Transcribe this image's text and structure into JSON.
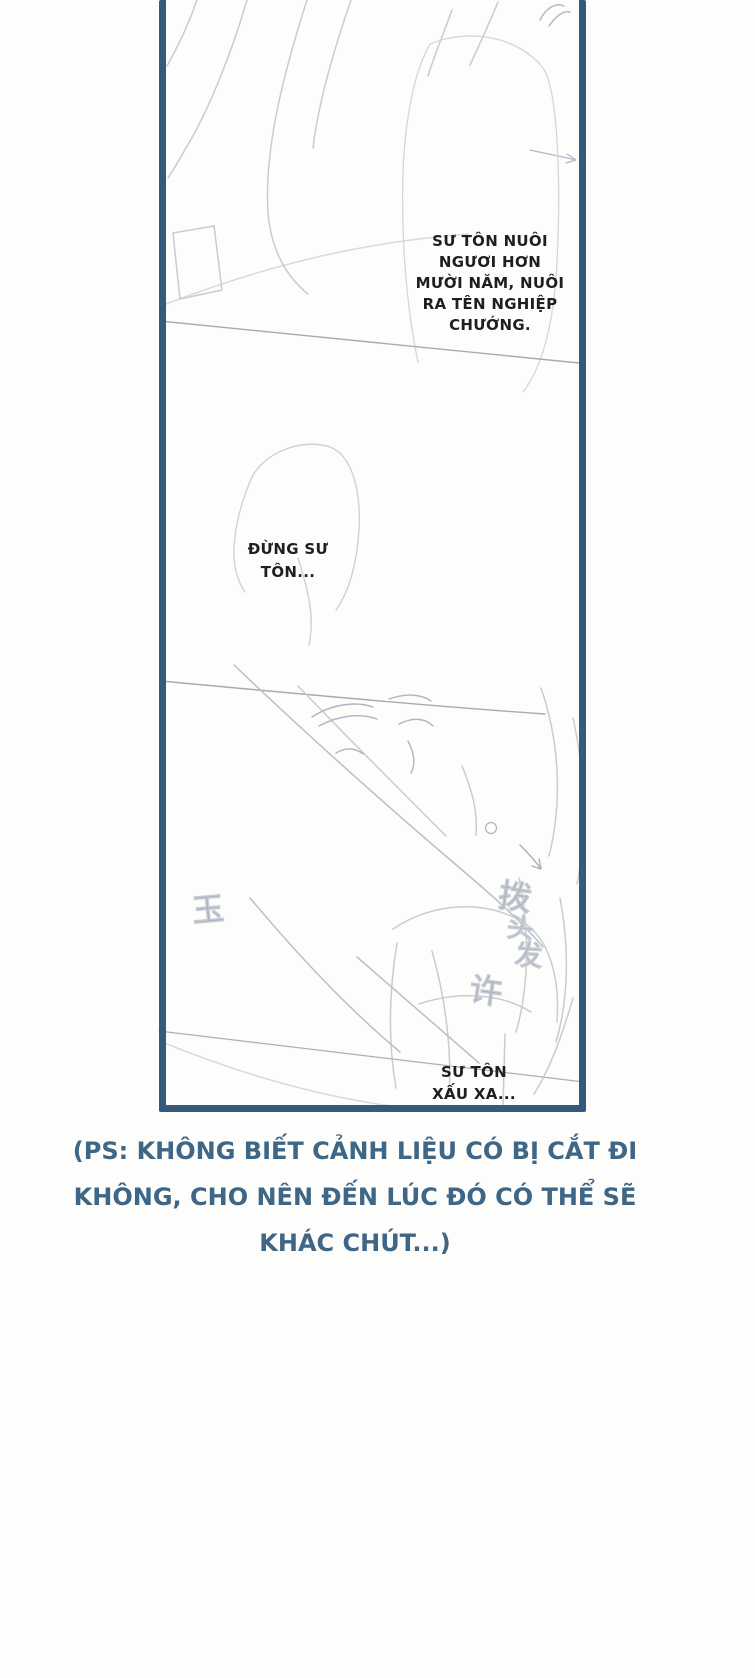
{
  "page": {
    "type": "comic-page",
    "background_color": "#fdfdfc",
    "frame_border_color": "#345a7c",
    "dialogue_color": "#1f1f1f",
    "note_color": "#3e6687",
    "sketch_color": "#c7cbd4"
  },
  "dialogue": {
    "bubble1": {
      "full_text": "SƯ TÔN NUÔI NGƯƠI HƠN MƯỜI NĂM, NUÔI RA TÊN NGHIỆP CHƯỚNG.",
      "lines": [
        "SƯ TÔN NUÔI",
        "NGƯƠI HƠN",
        "MƯỜI NĂM, NUÔI",
        "RA TÊN NGHIỆP",
        "CHƯỚNG."
      ]
    },
    "bubble2": {
      "full_text": "ĐỪNG SƯ TÔN...",
      "lines": [
        "ĐỪNG SƯ",
        "TÔN..."
      ]
    },
    "bubble3": {
      "full_text": "SƯ TÔN XẤU XA...",
      "lines": [
        "SƯ TÔN",
        "XẤU XA..."
      ]
    }
  },
  "sketch_annotations": {
    "char1": "玉",
    "char2": "拨",
    "char3": "头",
    "char4": "发",
    "char5": "许"
  },
  "note": {
    "full_text": "(PS: KHÔNG BIẾT CẢNH LIỆU CÓ BỊ CẮT ĐI KHÔNG, CHO NÊN ĐẾN LÚC ĐÓ CÓ THỂ SẼ KHÁC CHÚT...)",
    "lines": [
      "(PS: KHÔNG BIẾT CẢNH LIỆU CÓ BỊ CẮT ĐI",
      "KHÔNG, CHO NÊN ĐẾN LÚC ĐÓ CÓ THỂ SẼ",
      "KHÁC CHÚT...)"
    ]
  }
}
